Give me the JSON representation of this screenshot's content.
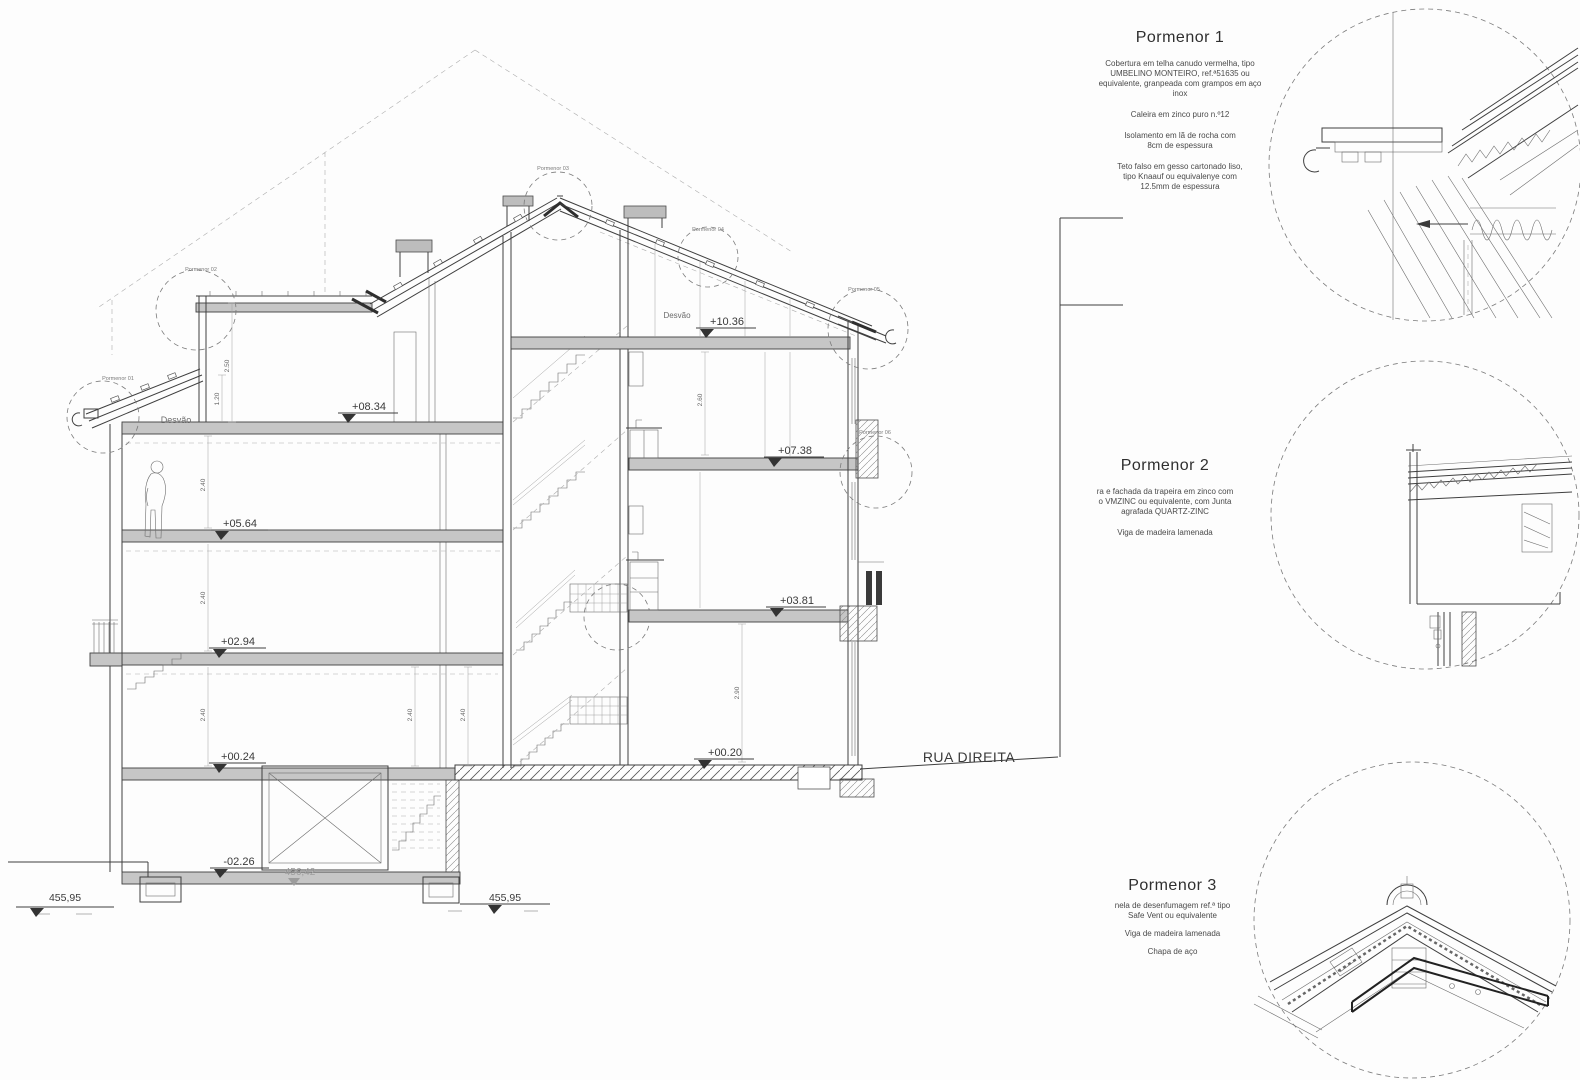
{
  "colors": {
    "paper": "#fdfdfd",
    "ink": "#3f3f3f",
    "ink_light": "#8c8c8c"
  },
  "section": {
    "street": "RUA DIREITA",
    "attic_left": "Desvão",
    "attic_right": "Desvão",
    "levels": [
      "+08.34",
      "+05.64",
      "+02.94",
      "+00.24",
      "-02.26",
      "+10.36",
      "+07.38",
      "+03.81",
      "+00.20"
    ],
    "datums": [
      "455,95",
      "455,95",
      "456,42"
    ],
    "dims": [
      "2.50",
      "1.20",
      "2.40",
      "2.40",
      "2.40",
      "2.40",
      "2.40",
      "2.60",
      "2.90"
    ],
    "tags": [
      "Pormenor 01",
      "Pormenor 02",
      "Pormenor 03",
      "Pormenor 04",
      "Pormenor 05",
      "Pormenor 06"
    ]
  },
  "details": [
    {
      "title": "Pormenor 1",
      "paragraphs": [
        "Cobertura em telha canudo vermelha, tipo\nUMBELINO MONTEIRO, ref.ª51635 ou\nequivalente, granpeada com grampos em aço\ninox",
        "Caleira em zinco puro n.º12",
        "Isolamento em lã de rocha com\n8cm de espessura",
        "Teto falso em gesso cartonado liso,\ntipo Knaauf ou equivalenye com\n12.5mm de espessura"
      ]
    },
    {
      "title": "Pormenor 2",
      "paragraphs": [
        "ra e fachada da trapeira em zinco com\no VMZINC ou equivalente, com Junta\nagrafada QUARTZ-ZINC",
        "Viga de madeira lamenada"
      ]
    },
    {
      "title": "Pormenor 3",
      "paragraphs": [
        "nela de desenfumagem ref.ª tipo\nSafe Vent  ou equivalente",
        "Viga de madeira lamenada",
        "Chapa de aço"
      ]
    }
  ]
}
